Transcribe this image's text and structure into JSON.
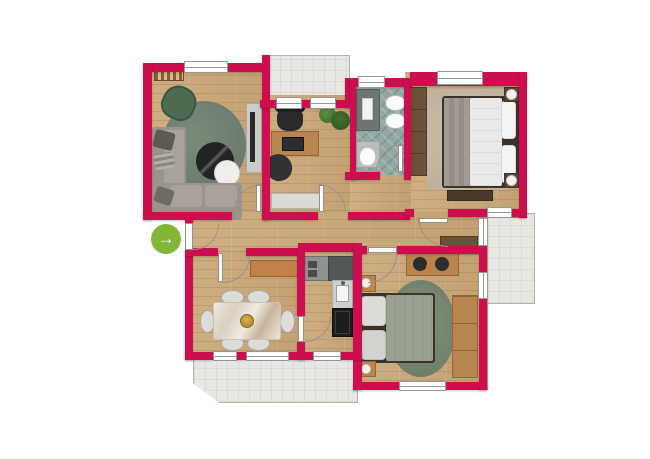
{
  "plan": {
    "kind": "apartment-floor-plan",
    "orientation": "top-down"
  },
  "palette": {
    "wall": "#ce0f4f",
    "wood": "#c9a87e",
    "bath_tile": "#93a8a5",
    "outdoor_tile": "#e8e7e2",
    "rug_green": "#73836f",
    "sofa_gray": "#9a948c",
    "accent_green": "#82b636",
    "counter_dark": "#535756",
    "marble_light": "#ece7df"
  },
  "entrance": {
    "icon": "arrow-right-icon",
    "glyph": "→"
  },
  "outdoor_areas": [
    "top-balcony",
    "right-balcony",
    "bottom-terrace"
  ],
  "rooms": [
    {
      "id": "living-room",
      "furniture": [
        "bookshelf",
        "green-armchair",
        "green-oval-rug",
        "round-coffee-table",
        "round-side-table",
        "corner-sofa",
        "tv-console"
      ]
    },
    {
      "id": "home-office",
      "furniture": [
        "desk",
        "office-chair",
        "laptop",
        "beanbag",
        "plants",
        "sideboard"
      ]
    },
    {
      "id": "bathroom",
      "furniture": [
        "shower",
        "sink",
        "sink",
        "toilet"
      ]
    },
    {
      "id": "main-bedroom",
      "furniture": [
        "wardrobe",
        "double-bed",
        "nightstand-with-lamp",
        "nightstand-with-lamp",
        "bench",
        "rug"
      ]
    },
    {
      "id": "hallway",
      "furniture": [
        "cabinet"
      ]
    },
    {
      "id": "dining-room",
      "furniture": [
        "sideboard",
        "marble-dining-table",
        "chair",
        "chair",
        "chair",
        "chair",
        "chair",
        "chair",
        "decor-bowl"
      ]
    },
    {
      "id": "kitchen",
      "furniture": [
        "counter",
        "cooktop",
        "sink-unit",
        "oven"
      ]
    },
    {
      "id": "second-bedroom",
      "furniture": [
        "desk",
        "stool",
        "stool",
        "bed",
        "green-oval-rug",
        "nightstand",
        "nightstand",
        "wardrobe"
      ]
    }
  ]
}
